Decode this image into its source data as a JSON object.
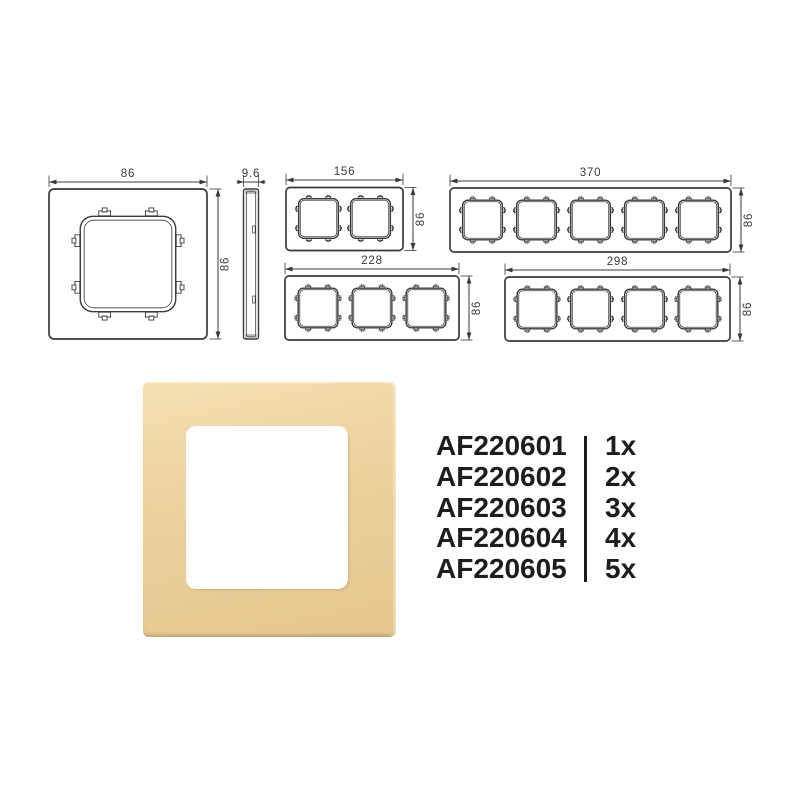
{
  "diagrams": {
    "front_1g": {
      "width_label": "86",
      "height_label": "86"
    },
    "side": {
      "depth_label": "9.6"
    },
    "front_2g": {
      "width_label": "156",
      "height_label": "86"
    },
    "front_3g": {
      "width_label": "228",
      "height_label": "86"
    },
    "front_4g": {
      "width_label": "298",
      "height_label": "86"
    },
    "front_5g": {
      "width_label": "370",
      "height_label": "86"
    }
  },
  "photo": {
    "frame_color": "#ecd09c",
    "frame_color_light": "#f4e0b0",
    "frame_color_dark": "#e5c78d"
  },
  "products": {
    "rows": [
      {
        "code": "AF220601",
        "qty": "1x"
      },
      {
        "code": "AF220602",
        "qty": "2x"
      },
      {
        "code": "AF220603",
        "qty": "3x"
      },
      {
        "code": "AF220604",
        "qty": "4x"
      },
      {
        "code": "AF220605",
        "qty": "5x"
      }
    ]
  }
}
